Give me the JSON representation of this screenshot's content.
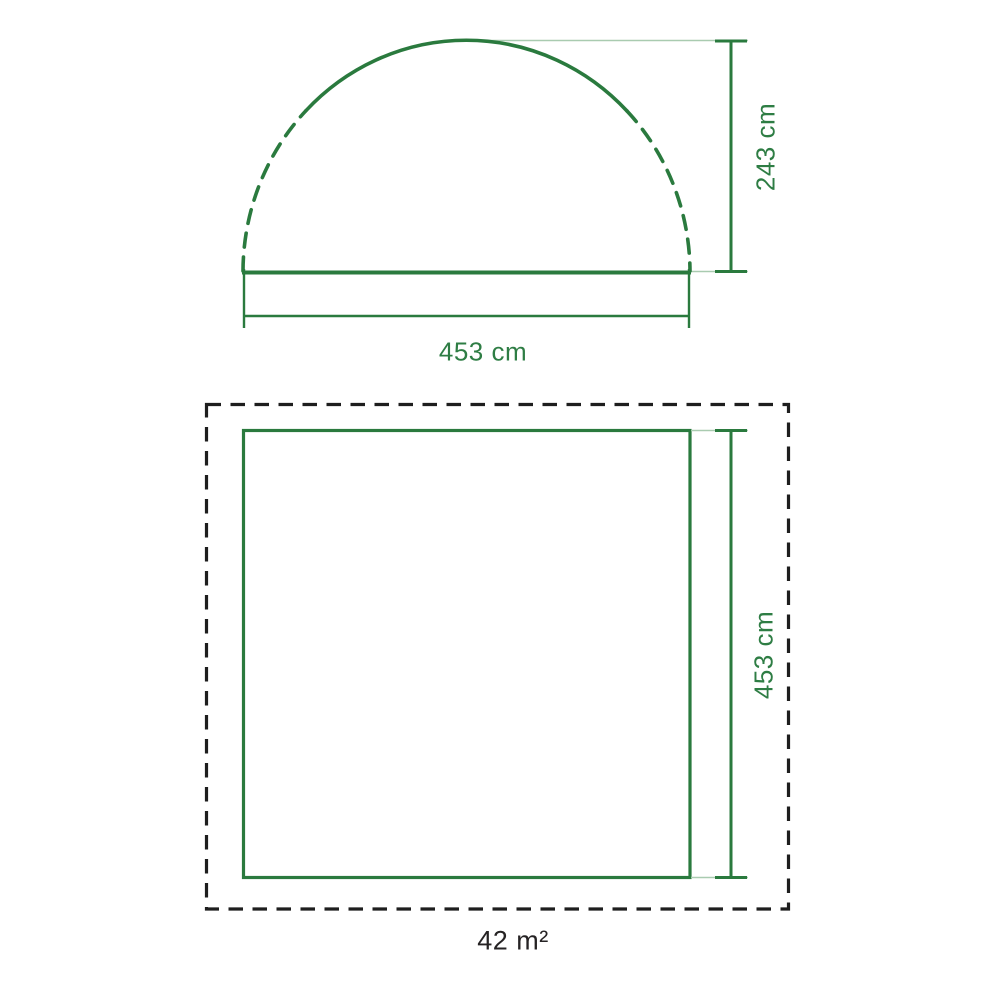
{
  "diagram_title": "tent-dimensions",
  "colors": {
    "line_green": "#2a7a3e",
    "text_green": "#2e7d44",
    "extension_green": "#a9cbb0",
    "dashed_black": "#1e1e1e",
    "text_dark": "#262324",
    "background": "#ffffff"
  },
  "side_view": {
    "shape": "dome-arch",
    "height": {
      "label": "243 cm"
    },
    "width": {
      "label": "453 cm"
    }
  },
  "floor_plan": {
    "shape": "square",
    "side": {
      "label": "453 cm"
    },
    "area": {
      "label": "42 m²"
    }
  }
}
